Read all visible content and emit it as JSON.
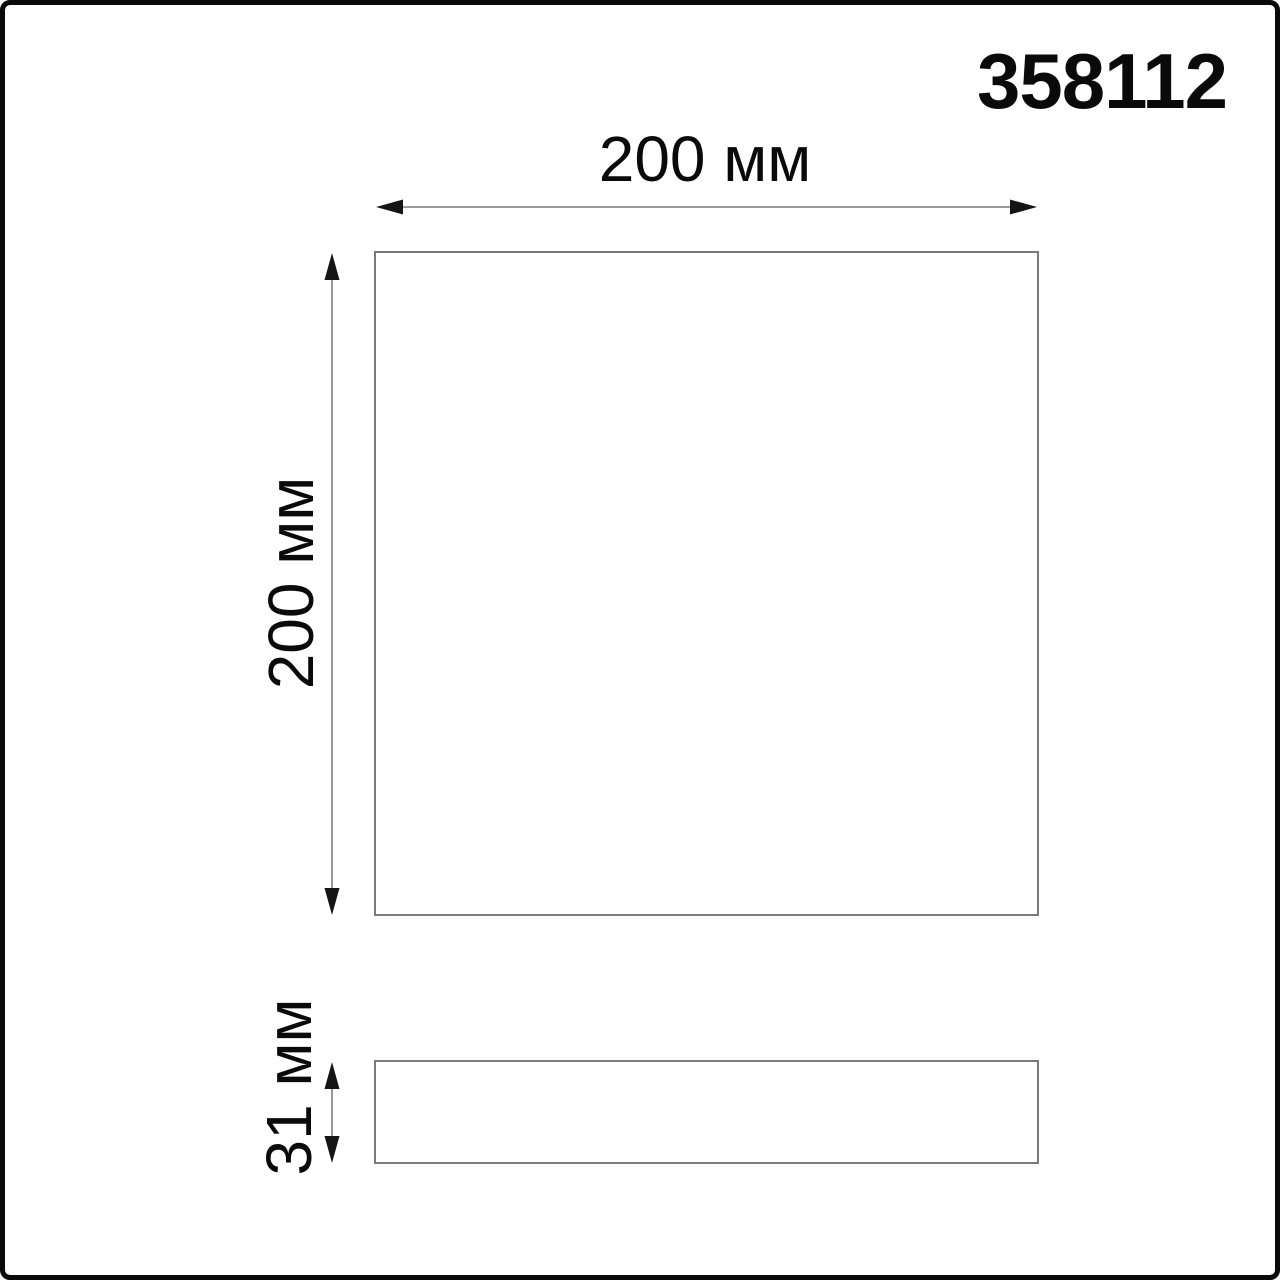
{
  "title": {
    "article_number": "358112"
  },
  "diagram": {
    "unit": "мм",
    "front_view": {
      "width_value": 200,
      "width_label": "200 мм",
      "height_value": 200,
      "height_label": "200 мм"
    },
    "side_view": {
      "depth_value": 31,
      "depth_label": "31 мм"
    }
  },
  "colors": {
    "background": "#ffffff",
    "frame_border": "#0a0a0a",
    "text": "#0a0a0a",
    "shape_stroke": "#7a7a7a",
    "dimension_line": "#8c8c8c",
    "arrowhead": "#151515"
  }
}
